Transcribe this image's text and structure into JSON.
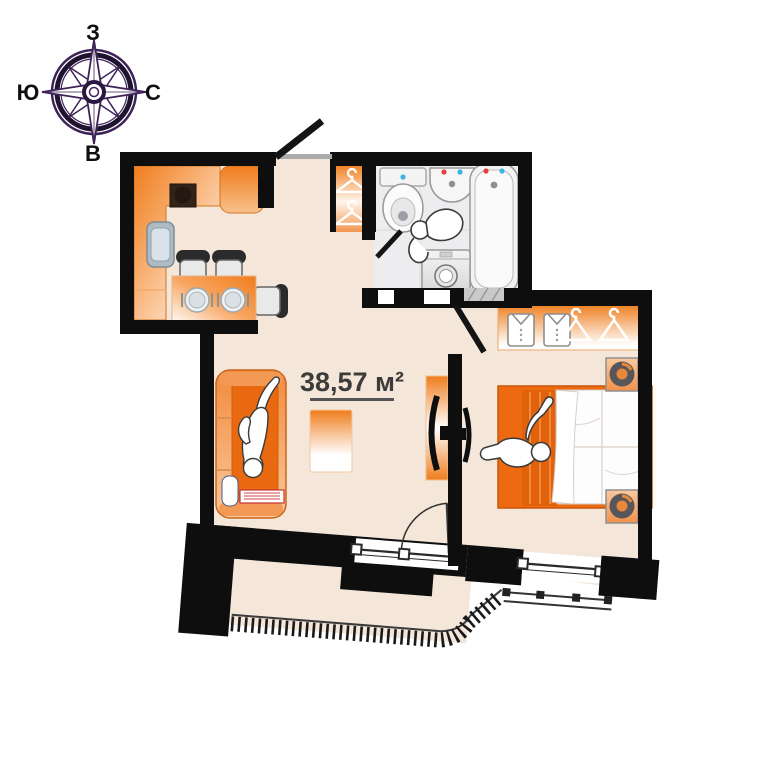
{
  "compass": {
    "top": "З",
    "right": "С",
    "bottom": "В",
    "left": "Ю"
  },
  "plan": {
    "area_label": "38,57 м²"
  },
  "colors": {
    "accent_orange": "#EF7D1C",
    "bed_orange": "#ED6A10",
    "wall_black": "#0E0E0E",
    "floor_beige": "#F4E6D9",
    "bath_floor": "#EDEDEF",
    "compass_purple": "#3E2359",
    "label_text": "#3C3C3C"
  },
  "icons": {
    "kitchen": [
      "counter",
      "stove",
      "sink",
      "fridge",
      "dining-table",
      "chair",
      "chair",
      "chair",
      "plate",
      "plate"
    ],
    "hallway": [
      "coat-hanger",
      "coat-hanger",
      "entry-door"
    ],
    "bathroom": [
      "toilet",
      "washbasin",
      "bathtub",
      "washing-machine",
      "person-figure",
      "door"
    ],
    "living_room": [
      "sofa",
      "person-figure",
      "rug",
      "tv",
      "tv-cabinet",
      "balcony-door",
      "pillow",
      "book"
    ],
    "bedroom": [
      "wardrobe",
      "shirt",
      "shirt",
      "coat-hanger",
      "coat-hanger",
      "bed",
      "person-figure",
      "nightstand",
      "nightstand",
      "tv",
      "window"
    ],
    "balcony": [
      "glazing-teeth",
      "railing"
    ]
  }
}
